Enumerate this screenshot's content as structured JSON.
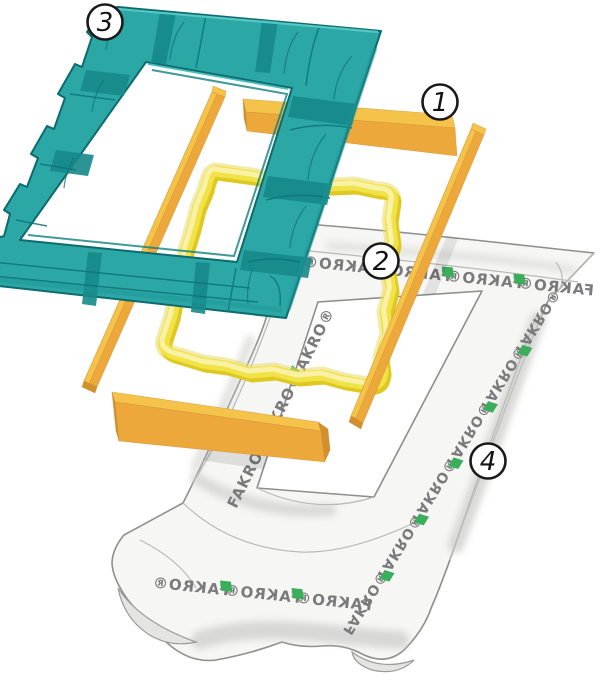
{
  "figure": {
    "kind": "exploded-assembly-illustration",
    "subject": "roof window flashing / insulation accessories kit",
    "background_color": "#ffffff"
  },
  "callouts": [
    {
      "number": "1"
    },
    {
      "number": "2"
    },
    {
      "number": "3"
    },
    {
      "number": "4"
    }
  ],
  "brand": {
    "label": "FAKRO®"
  },
  "colors": {
    "insulation_frame_teal": "#2BA8A6",
    "insulation_frame_teal_dark": "#17898A",
    "insulation_frame_outline": "#0B6B6E",
    "batten_top_face": "#F5C24A",
    "batten_front_face": "#ECA83B",
    "batten_end_face": "#D18F2E",
    "foam_seal_light": "#F8F3B0",
    "foam_seal_mid": "#F1E247",
    "foam_seal_shadow": "#E0C822",
    "membrane_fill": "#F6F6F4",
    "membrane_outline": "#8E8E8C",
    "membrane_print_gray": "#7A7A7C",
    "membrane_print_green": "#3BAE5C",
    "callout_fill": "#FFFFFF",
    "callout_stroke": "#1A1A1A"
  }
}
